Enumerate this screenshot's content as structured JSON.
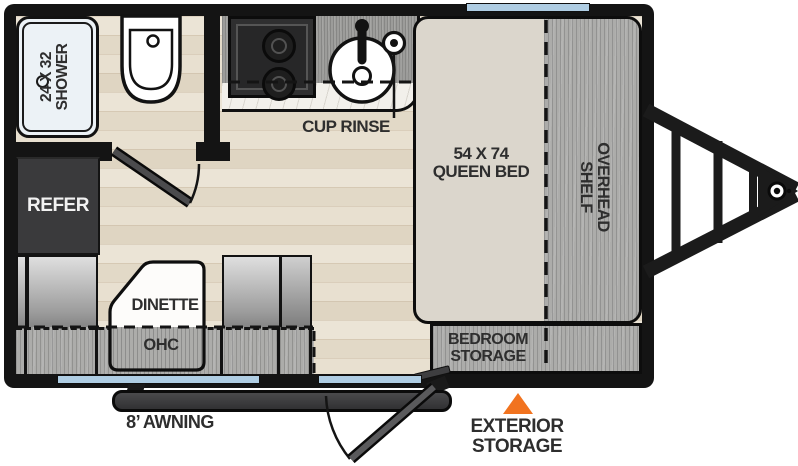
{
  "floorplan": {
    "bathroom": {
      "shower_label": "24 X 32\nSHOWER"
    },
    "kitchen": {
      "cup_rinse_label": "CUP RINSE",
      "refer_label": "REFER"
    },
    "dinette": {
      "dinette_label": "DINETTE",
      "ohc_label": "OHC"
    },
    "bedroom": {
      "bed_label": "54 X 74\nQUEEN BED",
      "overhead_shelf_label": "OVERHEAD\nSHELF",
      "storage_label": "BEDROOM\nSTORAGE"
    },
    "exterior": {
      "awning_label": "8’ AWNING",
      "exterior_storage_label": "EXTERIOR\nSTORAGE"
    }
  },
  "colors": {
    "wall": "#141414",
    "floor_wood": "#E7E0D2",
    "cabinet_gray": "#ACACAA",
    "counter_gray": "#9C9C9A",
    "marble": "#F2F0EB",
    "bed_fill": "#DBD6CC",
    "window_blue": "#AFCDE3",
    "accent_orange": "#F1731F",
    "refer_fill": "#3A3A3C",
    "label_text": "#2E2E2E",
    "refer_text": "#F2F2F2"
  },
  "icons": {
    "shower-drain-icon": "small circle",
    "toilet-icon": "toilet top view",
    "cooktop-icon": "two-burner stove",
    "sink-icon": "round sink with drain",
    "faucet-icon": "faucet stem with knob",
    "cup-rinse-icon": "double circle",
    "bathroom-door-icon": "door panel with swing arc",
    "entry-door-icon": "door panel with swing arc",
    "window-icon": "blue window strip",
    "awning-icon": "awning bar",
    "exterior-storage-marker-icon": "orange triangle",
    "trailer-tongue-hitch-icon": "A-frame tongue with coupler"
  }
}
